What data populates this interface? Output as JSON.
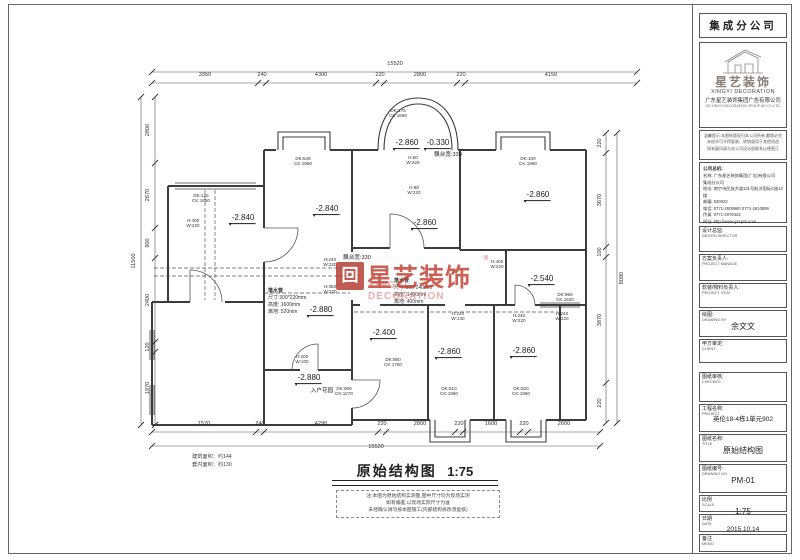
{
  "sidebar": {
    "branch": "集成分公司",
    "logo": {
      "cn": "星艺装饰",
      "en": "XINGYI DECORATION",
      "company_cn": "广东星艺装饰集团广告有限公司",
      "company_en": "GD XINGYI DECORATION GROUP AD CO.,LTD."
    },
    "notice_lines": [
      "温馨提示:本图纸版权归本公司所有,翻版必究",
      "未经许可不得复制、转借或用于其他用途",
      "如有疑问请与本公司设计部联系以便更正"
    ],
    "contact_title": "公司总机:",
    "contact_lines": [
      "名称: 广东星艺装饰集团(广告)有限公司",
      "集成分公司",
      "地址: 南宁市民族大道131号航洋国际C座12楼",
      "邮编: 530022",
      "电话: 0771-2609990  0771-2610899",
      "传真: 0771-2076422",
      "网址: http://www.gzxyzs.com"
    ],
    "fields": [
      {
        "label": "设计总监:",
        "sub": "DESIGN DIRECTOR",
        "value": ""
      },
      {
        "label": "方案负责人:",
        "sub": "PROJECT MANAGE",
        "value": ""
      },
      {
        "label": "软装/物料负责人:",
        "sub": "PROJECT ITEM",
        "value": ""
      },
      {
        "label": "绘图:",
        "sub": "DRAWING BY",
        "value": "余文文"
      },
      {
        "label": "甲方审定:",
        "sub": "CLIENT",
        "value": ""
      },
      {
        "label": "图纸审核:",
        "sub": "CHECKED",
        "value": ""
      },
      {
        "label": "工程名称:",
        "sub": "PROJECT",
        "value": "英伦18-4栋1单元902"
      },
      {
        "label": "图纸名称:",
        "sub": "TITLE",
        "value": "原始结构图"
      },
      {
        "label": "图纸编号:",
        "sub": "DRAWING NO.",
        "value": "PM-01"
      },
      {
        "label": "比例",
        "sub": "SCALE",
        "value": "1:75"
      },
      {
        "label": "日期",
        "sub": "DATE",
        "value": "2015.10.14"
      },
      {
        "label": "备注",
        "sub": "MEMO",
        "value": ""
      }
    ]
  },
  "drawing": {
    "title": "原始结构图",
    "scale": "1:75",
    "notes": [
      "注:本图为原始结构实测图,图中尺寸均为现场实测",
      "如有偏差,以现场实际尺寸为准",
      "未经确认请勿按本图施工(内部结构拆改须复核)"
    ],
    "area_lines": [
      "建筑面积：约144",
      "套内面积：约130"
    ],
    "watermark": {
      "icon": "回",
      "cn": "星艺装饰",
      "reg": "®",
      "en": "XINGYI DECORATION"
    },
    "labels": [
      {
        "x": 395,
        "y": 64,
        "c": "dim",
        "t": "15520"
      },
      {
        "x": 205,
        "y": 75,
        "c": "dim",
        "t": "3350"
      },
      {
        "x": 262,
        "y": 75,
        "c": "dim",
        "t": "240"
      },
      {
        "x": 321,
        "y": 75,
        "c": "dim",
        "t": "4300"
      },
      {
        "x": 380,
        "y": 75,
        "c": "dim",
        "t": "220"
      },
      {
        "x": 420,
        "y": 75,
        "c": "dim",
        "t": "2800"
      },
      {
        "x": 461,
        "y": 75,
        "c": "dim",
        "t": "220"
      },
      {
        "x": 551,
        "y": 75,
        "c": "dim",
        "t": "4150"
      },
      {
        "x": 204,
        "y": 424,
        "c": "dim",
        "t": "1570"
      },
      {
        "x": 260,
        "y": 424,
        "c": "dim",
        "t": "240"
      },
      {
        "x": 321,
        "y": 424,
        "c": "dim",
        "t": "4290"
      },
      {
        "x": 382,
        "y": 424,
        "c": "dim",
        "t": "220"
      },
      {
        "x": 420,
        "y": 424,
        "c": "dim",
        "t": "2800"
      },
      {
        "x": 459,
        "y": 424,
        "c": "dim",
        "t": "220"
      },
      {
        "x": 491,
        "y": 424,
        "c": "dim",
        "t": "1600"
      },
      {
        "x": 524,
        "y": 424,
        "c": "dim",
        "t": "220"
      },
      {
        "x": 564,
        "y": 424,
        "c": "dim",
        "t": "2600"
      },
      {
        "x": 376,
        "y": 447,
        "c": "dim",
        "t": "15520"
      },
      {
        "x": 148,
        "y": 130,
        "c": "dimv",
        "t": "2800"
      },
      {
        "x": 148,
        "y": 195,
        "c": "dimv",
        "t": "2670"
      },
      {
        "x": 148,
        "y": 243,
        "c": "dimv",
        "t": "900"
      },
      {
        "x": 148,
        "y": 300,
        "c": "dimv",
        "t": "2400"
      },
      {
        "x": 148,
        "y": 347,
        "c": "dimv",
        "t": "120"
      },
      {
        "x": 148,
        "y": 388,
        "c": "dimv",
        "t": "1970"
      },
      {
        "x": 134,
        "y": 261,
        "c": "dimv",
        "t": "11500"
      },
      {
        "x": 600,
        "y": 143,
        "c": "dimv",
        "t": "220"
      },
      {
        "x": 600,
        "y": 200,
        "c": "dimv",
        "t": "3670"
      },
      {
        "x": 600,
        "y": 252,
        "c": "dimv",
        "t": "100"
      },
      {
        "x": 600,
        "y": 320,
        "c": "dimv",
        "t": "3870"
      },
      {
        "x": 600,
        "y": 403,
        "c": "dimv",
        "t": "220"
      },
      {
        "x": 622,
        "y": 278,
        "c": "dimv",
        "t": "8080"
      },
      {
        "x": 243,
        "y": 219,
        "c": "elev",
        "t": "-2.840"
      },
      {
        "x": 327,
        "y": 210,
        "c": "elev",
        "t": "-2.840"
      },
      {
        "x": 407,
        "y": 144,
        "c": "elev",
        "t": "-2.860"
      },
      {
        "x": 438,
        "y": 144,
        "c": "elev",
        "t": "-0.330"
      },
      {
        "x": 425,
        "y": 224,
        "c": "elev",
        "t": "-2.860"
      },
      {
        "x": 538,
        "y": 196,
        "c": "elev",
        "t": "-2.860"
      },
      {
        "x": 321,
        "y": 311,
        "c": "elev",
        "t": "-2.880"
      },
      {
        "x": 384,
        "y": 334,
        "c": "elev",
        "t": "-2.400"
      },
      {
        "x": 449,
        "y": 353,
        "c": "elev",
        "t": "-2.860"
      },
      {
        "x": 524,
        "y": 352,
        "c": "elev",
        "t": "-2.860"
      },
      {
        "x": 542,
        "y": 280,
        "c": "elev",
        "t": "-2.540"
      },
      {
        "x": 309,
        "y": 379,
        "c": "elev",
        "t": "-2.880"
      },
      {
        "x": 322,
        "y": 391,
        "c": "tiny",
        "t": "入户花园"
      },
      {
        "x": 357,
        "y": 258,
        "c": "tiny",
        "t": "飘台宽:330"
      },
      {
        "x": 448,
        "y": 155,
        "c": "tiny",
        "t": "飘台宽:330"
      },
      {
        "x": 201,
        "y": 198,
        "c": "wl",
        "lines": [
          "DK:125",
          "CK:1650"
        ]
      },
      {
        "x": 303,
        "y": 161,
        "c": "wl",
        "lines": [
          "DK:540",
          "CK:1950"
        ]
      },
      {
        "x": 398,
        "y": 113,
        "c": "wl",
        "lines": [
          "DK:175",
          "CK:1850"
        ]
      },
      {
        "x": 528,
        "y": 161,
        "c": "wl",
        "lines": [
          "DK:100",
          "CK:1960"
        ]
      },
      {
        "x": 449,
        "y": 391,
        "c": "wl",
        "lines": [
          "DK:510",
          "CK:1960"
        ]
      },
      {
        "x": 521,
        "y": 391,
        "c": "wl",
        "lines": [
          "DK:520",
          "CK:1960"
        ]
      },
      {
        "x": 565,
        "y": 297,
        "c": "wl",
        "lines": [
          "DK:960",
          "CK:1620"
        ]
      },
      {
        "x": 393,
        "y": 362,
        "c": "wl",
        "lines": [
          "DK:950",
          "CK:1750"
        ]
      },
      {
        "x": 344,
        "y": 391,
        "c": "wl",
        "lines": [
          "DK:960",
          "CK:1270"
        ]
      },
      {
        "x": 193,
        "y": 223,
        "c": "wl",
        "lines": [
          "H:400",
          "W:220"
        ]
      },
      {
        "x": 330,
        "y": 262,
        "c": "wl",
        "lines": [
          "H:240",
          "W:220"
        ]
      },
      {
        "x": 330,
        "y": 289,
        "c": "wl",
        "lines": [
          "H:350",
          "W:220"
        ]
      },
      {
        "x": 413,
        "y": 160,
        "c": "wl",
        "lines": [
          "H:60",
          "W:220"
        ]
      },
      {
        "x": 414,
        "y": 190,
        "c": "wl",
        "lines": [
          "H:80",
          "W:220"
        ]
      },
      {
        "x": 497,
        "y": 264,
        "c": "wl",
        "lines": [
          "H:400",
          "W:220"
        ]
      },
      {
        "x": 519,
        "y": 318,
        "c": "wl",
        "lines": [
          "H:240",
          "W:220"
        ]
      },
      {
        "x": 302,
        "y": 359,
        "c": "wl",
        "lines": [
          "H:200",
          "W:100"
        ]
      },
      {
        "x": 458,
        "y": 316,
        "c": "wl",
        "lines": [
          "H:240",
          "W:140"
        ]
      },
      {
        "x": 562,
        "y": 316,
        "c": "wl",
        "lines": [
          "H:240",
          "W:220"
        ]
      },
      {
        "x": 268,
        "y": 302,
        "c": "note",
        "lines": [
          "落水管",
          "尺寸:300*220mm",
          "高度: 1600mm",
          "离地: 520mm"
        ]
      },
      {
        "x": 394,
        "y": 292,
        "c": "note",
        "lines": [
          "落水管",
          "尺寸:800*240mm",
          "高度: 1400mm",
          "离地: 400mm"
        ]
      }
    ]
  }
}
